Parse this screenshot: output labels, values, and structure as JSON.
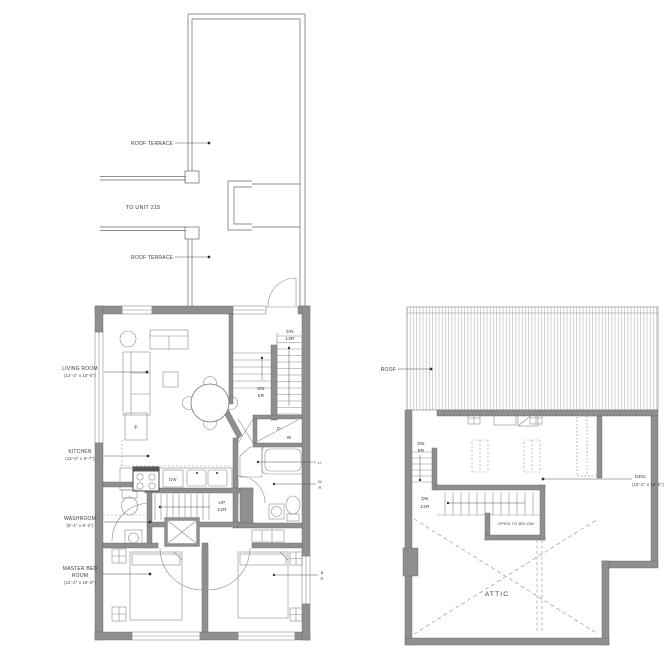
{
  "left_plan": {
    "annotations": {
      "roof_terrace_upper": "ROOF TERRACE",
      "roof_terrace_lower": "ROOF TERRACE",
      "to_unit": "TO UNIT 215"
    },
    "rooms": {
      "living_name": "LIVING ROOM",
      "living_dim": "(14'-2\" x 10'-5\")",
      "kitchen_name": "KITCHEN",
      "kitchen_dim": "(12'-0\" x 9'-7\")",
      "washroom_name": "WASHROOM",
      "washroom_dim": "(8'-4\" x 8'-2\")",
      "master_name_line1": "MASTER BED",
      "master_name_line2": "ROOM",
      "master_dim": "(12'-2\" x 10'-0\")"
    },
    "stairs": {
      "dn13_line1": "DN",
      "dn13_line2": "13R",
      "dn5_line1": "DN",
      "dn5_line2": "5R",
      "up12_line1": "UP",
      "up12_line2": "12R"
    },
    "fixtures": {
      "dishwasher": "DW",
      "furnace": "F",
      "dryer": "D",
      "washer": "W"
    },
    "tags": {
      "linen": "LI",
      "washroom_tag_line1": "W",
      "washroom_tag_line2": "R",
      "bedroom_tag_line1": "B",
      "bedroom_tag_line2": "R"
    }
  },
  "right_plan": {
    "annotations": {
      "roof": "ROOF",
      "den_name": "DEN",
      "den_dim": "(19'-2\" x 19'-0\")",
      "open_to_below": "OPEN TO BELOW",
      "attic": "ATTIC"
    },
    "stairs": {
      "dn6_line1": "DN",
      "dn6_line2": "6R",
      "dn12_line1": "DN",
      "dn12_line2": "12R"
    }
  }
}
